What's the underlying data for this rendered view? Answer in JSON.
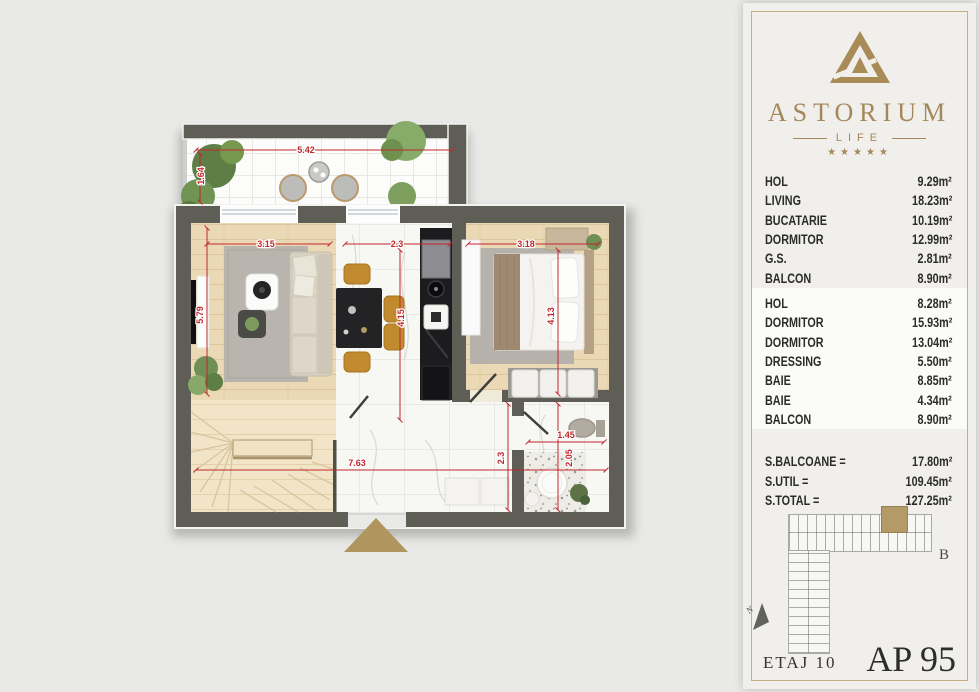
{
  "panel": {
    "brand": {
      "name": "ASTORIUM",
      "tagline": "LIFE",
      "stars": "★★★★★"
    },
    "rooms_upper": [
      {
        "label": "HOL",
        "area": "9.29m²"
      },
      {
        "label": "LIVING",
        "area": "18.23m²"
      },
      {
        "label": "BUCATARIE",
        "area": "10.19m²"
      },
      {
        "label": "DORMITOR",
        "area": "12.99m²"
      },
      {
        "label": "G.S.",
        "area": "2.81m²"
      },
      {
        "label": "BALCON",
        "area": "8.90m²"
      }
    ],
    "rooms_lower": [
      {
        "label": "HOL",
        "area": "8.28m²"
      },
      {
        "label": "DORMITOR",
        "area": "15.93m²"
      },
      {
        "label": "DORMITOR",
        "area": "13.04m²"
      },
      {
        "label": "DRESSING",
        "area": "5.50m²"
      },
      {
        "label": "BAIE",
        "area": "8.85m²"
      },
      {
        "label": "BAIE",
        "area": "4.34m²"
      },
      {
        "label": "BALCON",
        "area": "8.90m²"
      }
    ],
    "totals": [
      {
        "label": "S.BALCOANE =",
        "value": "17.80m²"
      },
      {
        "label": "S.UTIL =",
        "value": "109.45m²"
      },
      {
        "label": "S.TOTAL =",
        "value": "127.25m²"
      }
    ],
    "minimap": {
      "section": "B",
      "compass": "N"
    },
    "footer": {
      "floor": "ETAJ 10",
      "apartment": "AP 95"
    }
  },
  "floorplan": {
    "dims": {
      "balcony_w": "5.42",
      "balcony_d": "1.64",
      "living_w": "3.15",
      "hall_w": "2.3",
      "bedroom_w": "3.18",
      "living_h": "5.79",
      "hall_h": "4.15",
      "bedroom_h": "4.13",
      "hall2_h": "2.3",
      "bath_w": "1.45",
      "bath_h": "2.05",
      "total_w": "7.63"
    }
  },
  "colors": {
    "accent_gold": "#ab8d55",
    "dimension_red": "#c1272d",
    "wall": "#5f5e56"
  }
}
